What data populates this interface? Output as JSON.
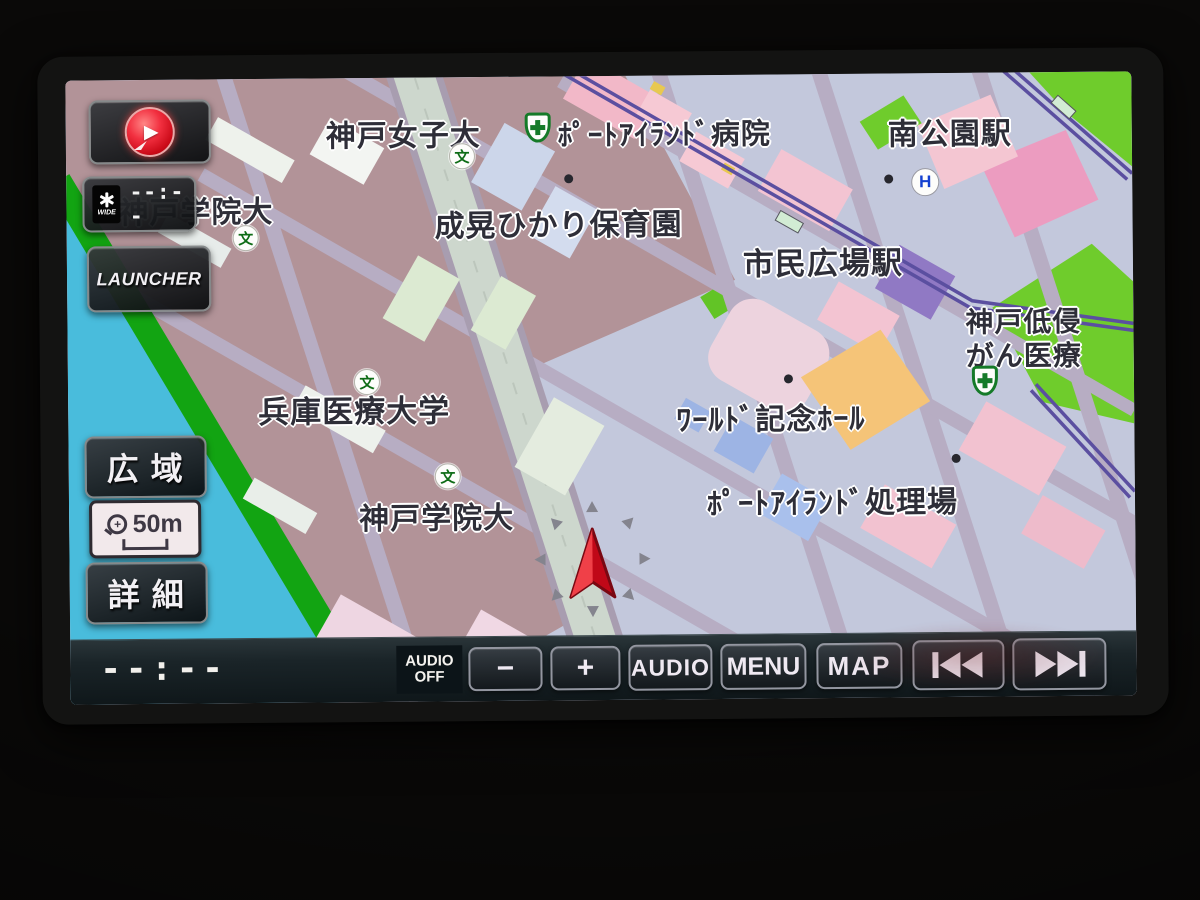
{
  "scene": {
    "description": "car navigation head unit displaying Kobe Port Island map"
  },
  "overlay": {
    "compass": {
      "icon": "heading-up-compass-icon"
    },
    "vics": {
      "icon": "vics-wide-icon",
      "wide_label": "WIDE",
      "time": "--:--"
    },
    "launcher_label": "LAUNCHER",
    "zoom": {
      "wide_label": "広域",
      "scale_text": "50m",
      "detail_label": "詳細",
      "magnifier_icon": "zoom-in-magnifier-icon"
    }
  },
  "bottom_bar": {
    "clock": "--:--",
    "audio_off_line1": "AUDIO",
    "audio_off_line2": "OFF",
    "minus_label": "−",
    "plus_label": "+",
    "audio_label": "AUDIO",
    "menu_label": "MENU",
    "map_label": "MAP",
    "prev_icon": "prev-track-icon",
    "next_icon": "next-track-icon"
  },
  "map": {
    "labels": [
      {
        "id": "kobe-joshi-dai",
        "text": "神戸女子大"
      },
      {
        "id": "port-island-hospital",
        "text": "ﾎﾟｰﾄｱｲﾗﾝﾄﾞ病院"
      },
      {
        "id": "minami-koen-station",
        "text": "南公園駅"
      },
      {
        "id": "kobe-gakuin-dai-north",
        "text": "神戸学院大"
      },
      {
        "id": "seiko-hikari-hoikuen",
        "text": "成晃ひかり保育園"
      },
      {
        "id": "shimin-hiroba-station",
        "text": "市民広場駅"
      },
      {
        "id": "kobe-teishin-line1",
        "text": "神戸低侵"
      },
      {
        "id": "kobe-teishin-line2",
        "text": "がん医療"
      },
      {
        "id": "hyogo-iryo-daigaku",
        "text": "兵庫医療大学"
      },
      {
        "id": "world-kinen-hall",
        "text": "ﾜｰﾙﾄﾞ記念ﾎｰﾙ"
      },
      {
        "id": "kobe-gakuin-dai-south",
        "text": "神戸学院大"
      },
      {
        "id": "port-island-shorijo",
        "text": "ﾎﾟｰﾄｱｲﾗﾝﾄﾞ処理場"
      }
    ],
    "poi": {
      "school_char": "文",
      "heliport_char": "H"
    },
    "colors": {
      "water": "#49bcdc",
      "shore_green": "#12a412",
      "land_base": "#c3c8dc",
      "campus_block": "#b29398",
      "road_boulevard": "#cdd7cd",
      "road_minor": "#b7adc3",
      "railway_purple": "#5b4fa0",
      "park_green": "#6fcc2c",
      "building_pink": "#f3c4d2",
      "building_orange": "#f5c478",
      "building_blue": "#a9c0ec",
      "arena_purple": "#9079c4",
      "position_arrow_red": "#d81525",
      "bar_background": "#18232a"
    }
  }
}
